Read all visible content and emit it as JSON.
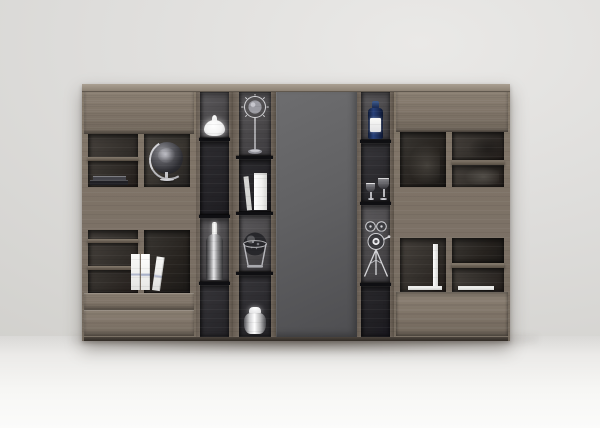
{
  "scene": {
    "type": "furniture-product-photo",
    "subject": "modern modular wall unit bookcase, straight-on studio render",
    "composition": "two wood-front cabinets flank three dark open display columns and a central flat gray panel",
    "background": "plain light gray wall, bright reflective floor with soft shadow under the unit"
  },
  "palette": {
    "wall": "#dcdbd9",
    "floor": "#f6f6f4",
    "wood": "#7c7166",
    "wood_light": "#aaa092",
    "wood_dark": "#5b5248",
    "niche_mid": "#494749",
    "niche_dark": "#242327",
    "center_panel_gray": "#5e5e60",
    "decor_white": "#f4f4f2",
    "decor_silver": "#cfcfd3",
    "decor_navy": "#1d2d52"
  },
  "decor": {
    "left_cabinet": [
      "stacked-dark-books",
      "black-speckled-globe-on-stand",
      "three-white-standing-books"
    ],
    "column_1": [
      "white-dome-vase",
      "steel-bottle-vase"
    ],
    "column_2": [
      "sputnik-sphere-ornament",
      "white-standing-book",
      "caged-desk-globe",
      "white-steel-jar"
    ],
    "column_3": [
      "blue-bottle-with-white-label",
      "two-wine-glasses",
      "film-projector-on-tripod"
    ],
    "right_cabinet": [
      "white-bookend",
      "white-flat-book"
    ]
  }
}
